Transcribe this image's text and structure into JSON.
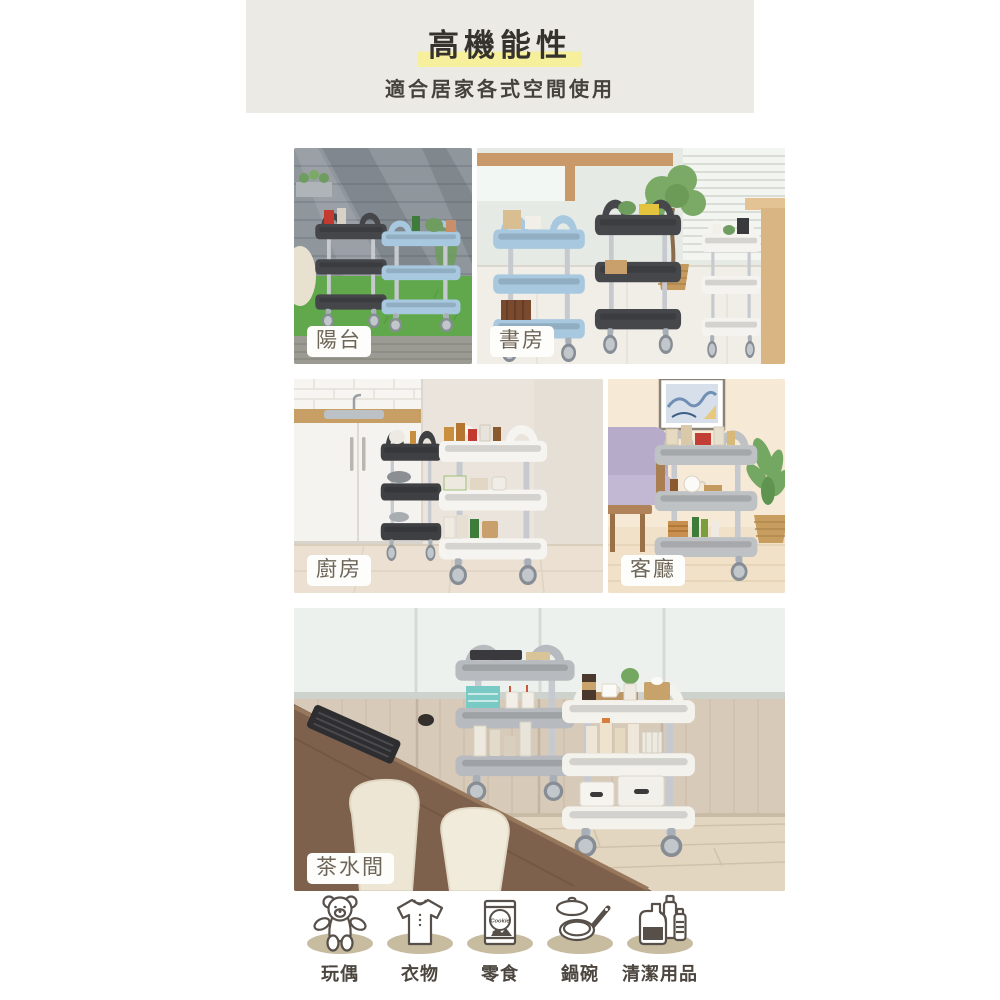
{
  "header": {
    "title": "高機能性",
    "subtitle": "適合居家各式空間使用",
    "bg": "#ECEAE4",
    "highlight_color": "#F6EF9B"
  },
  "photos": [
    {
      "id": "balcony",
      "label": "陽台"
    },
    {
      "id": "study",
      "label": "書房"
    },
    {
      "id": "kitchen",
      "label": "廚房"
    },
    {
      "id": "living",
      "label": "客廳"
    },
    {
      "id": "pantry",
      "label": "茶水間"
    }
  ],
  "icons": [
    {
      "id": "plush-toy",
      "label": "玩偶",
      "icon": "teddy-bear-icon"
    },
    {
      "id": "clothing",
      "label": "衣物",
      "icon": "tshirt-icon"
    },
    {
      "id": "snacks",
      "label": "零食",
      "icon": "snack-bag-icon",
      "bag_text": "Cookie"
    },
    {
      "id": "cookware",
      "label": "鍋碗",
      "icon": "pan-icon"
    },
    {
      "id": "cleaning-supplies",
      "label": "清潔用品",
      "icon": "detergent-icon"
    }
  ],
  "colors": {
    "page_bg": "#FFFFFF",
    "header_bg": "#ECEAE4",
    "highlight": "#F6EF9B",
    "title_text": "#35322D",
    "subtitle_text": "#45413C",
    "caption_text": "#6E6557",
    "caption_bg": "#FDFDFB",
    "icon_shadow": "#C7BC9F",
    "icon_line": "#57504A",
    "icon_label_text": "#4C463F",
    "cart_black": "#45464A",
    "cart_blue": "#A8C8DF",
    "cart_white": "#F4F3EF",
    "cart_gray": "#BCBFC2"
  }
}
